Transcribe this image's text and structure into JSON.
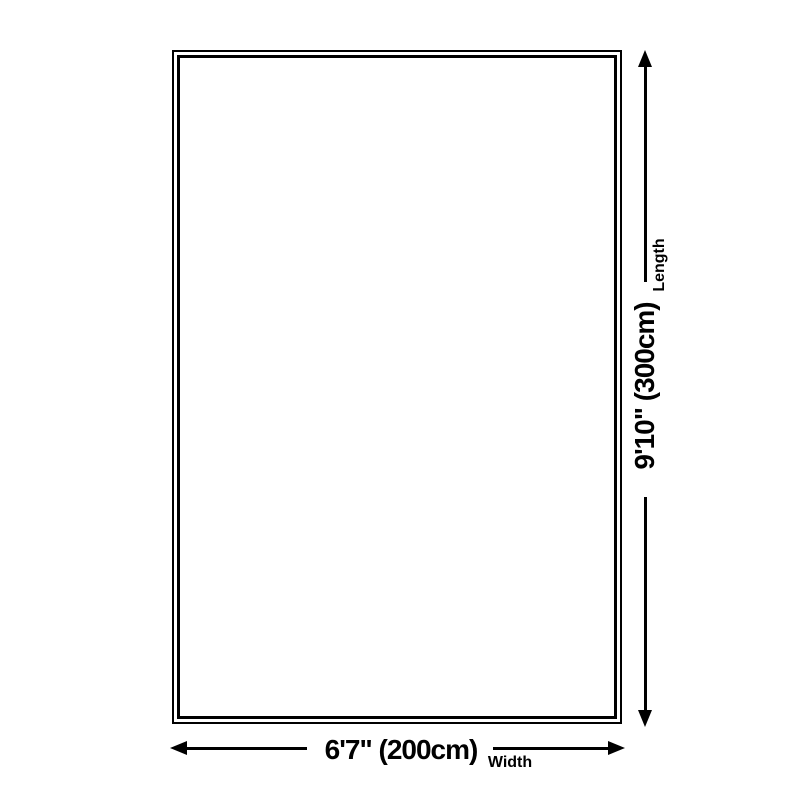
{
  "diagram": {
    "shape": "rectangle",
    "background_color": "#ffffff",
    "line_color": "#000000",
    "width_dimension": {
      "value": "6'7\" (200cm)",
      "label": "Width"
    },
    "length_dimension": {
      "value": "9'10\" (300cm)",
      "label": "Length"
    }
  }
}
